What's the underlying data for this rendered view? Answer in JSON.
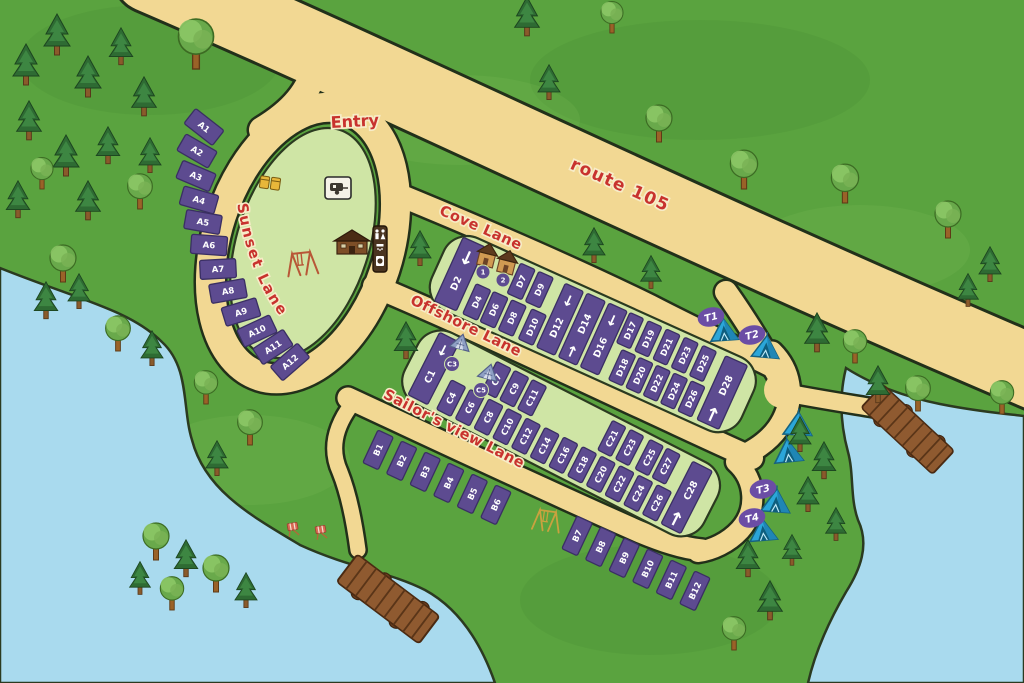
{
  "map": {
    "labels": {
      "entry": "Entry",
      "route": "route 105",
      "cove": "Cove Lane",
      "offshore": "Offshore Lane",
      "sailors": "Sailor's view Lane",
      "sunset": "Sunset Lane"
    },
    "icons": {
      "arrow_up": "↑",
      "arrow_down": "↓",
      "conifer": "conifer-tree",
      "deciduous": "deciduous-tree",
      "tent": "tent",
      "hut": "rental-hut",
      "shelter": "shelter-tent",
      "dock": "wooden-dock",
      "swing": "swing-set",
      "chair": "beach-chair",
      "trash": "recycling-bins",
      "rv": "rv-caravan-sign",
      "services": "restroom-shower-laundry-sign",
      "cabin": "reception-cabin"
    },
    "colors": {
      "grass": "#5aa33f",
      "road": "#f2d893",
      "island": "#cfe5a5",
      "site": "#5d4b90",
      "water": "#a9daee",
      "sand": "#dcbd80",
      "label_red": "#c8322e",
      "tent_blue": "#2ba6d9",
      "marker_purple": "#6b4da5"
    },
    "sites": {
      "a": [
        "A1",
        "A2",
        "A3",
        "A4",
        "A5",
        "A6",
        "A7",
        "A8",
        "A9",
        "A10",
        "A11",
        "A12"
      ],
      "b": [
        "B1",
        "B2",
        "B3",
        "B4",
        "B5",
        "B6",
        "B7",
        "B8",
        "B9",
        "B10",
        "B11",
        "B12"
      ],
      "c_full": [
        "C1",
        "C28"
      ],
      "c_top": [
        "C7",
        "C9",
        "C11",
        "C21",
        "C23",
        "C25",
        "C27"
      ],
      "c_bottom": [
        "C4",
        "C6",
        "C8",
        "C10",
        "C12",
        "C14",
        "C16",
        "C18",
        "C20",
        "C22",
        "C24",
        "C26"
      ],
      "c_shelters": [
        "C3",
        "C5"
      ],
      "d_full": [
        "D2",
        "D12",
        "D14",
        "D16",
        "D28"
      ],
      "d_top": [
        "D7",
        "D9",
        "D17",
        "D19",
        "D21",
        "D23",
        "D25"
      ],
      "d_bottom": [
        "D4",
        "D6",
        "D8",
        "D10",
        "D18",
        "D20",
        "D22",
        "D24",
        "D26"
      ],
      "huts": [
        "1",
        "2"
      ],
      "tents": [
        "T1",
        "T2",
        "T3",
        "T4"
      ]
    }
  }
}
